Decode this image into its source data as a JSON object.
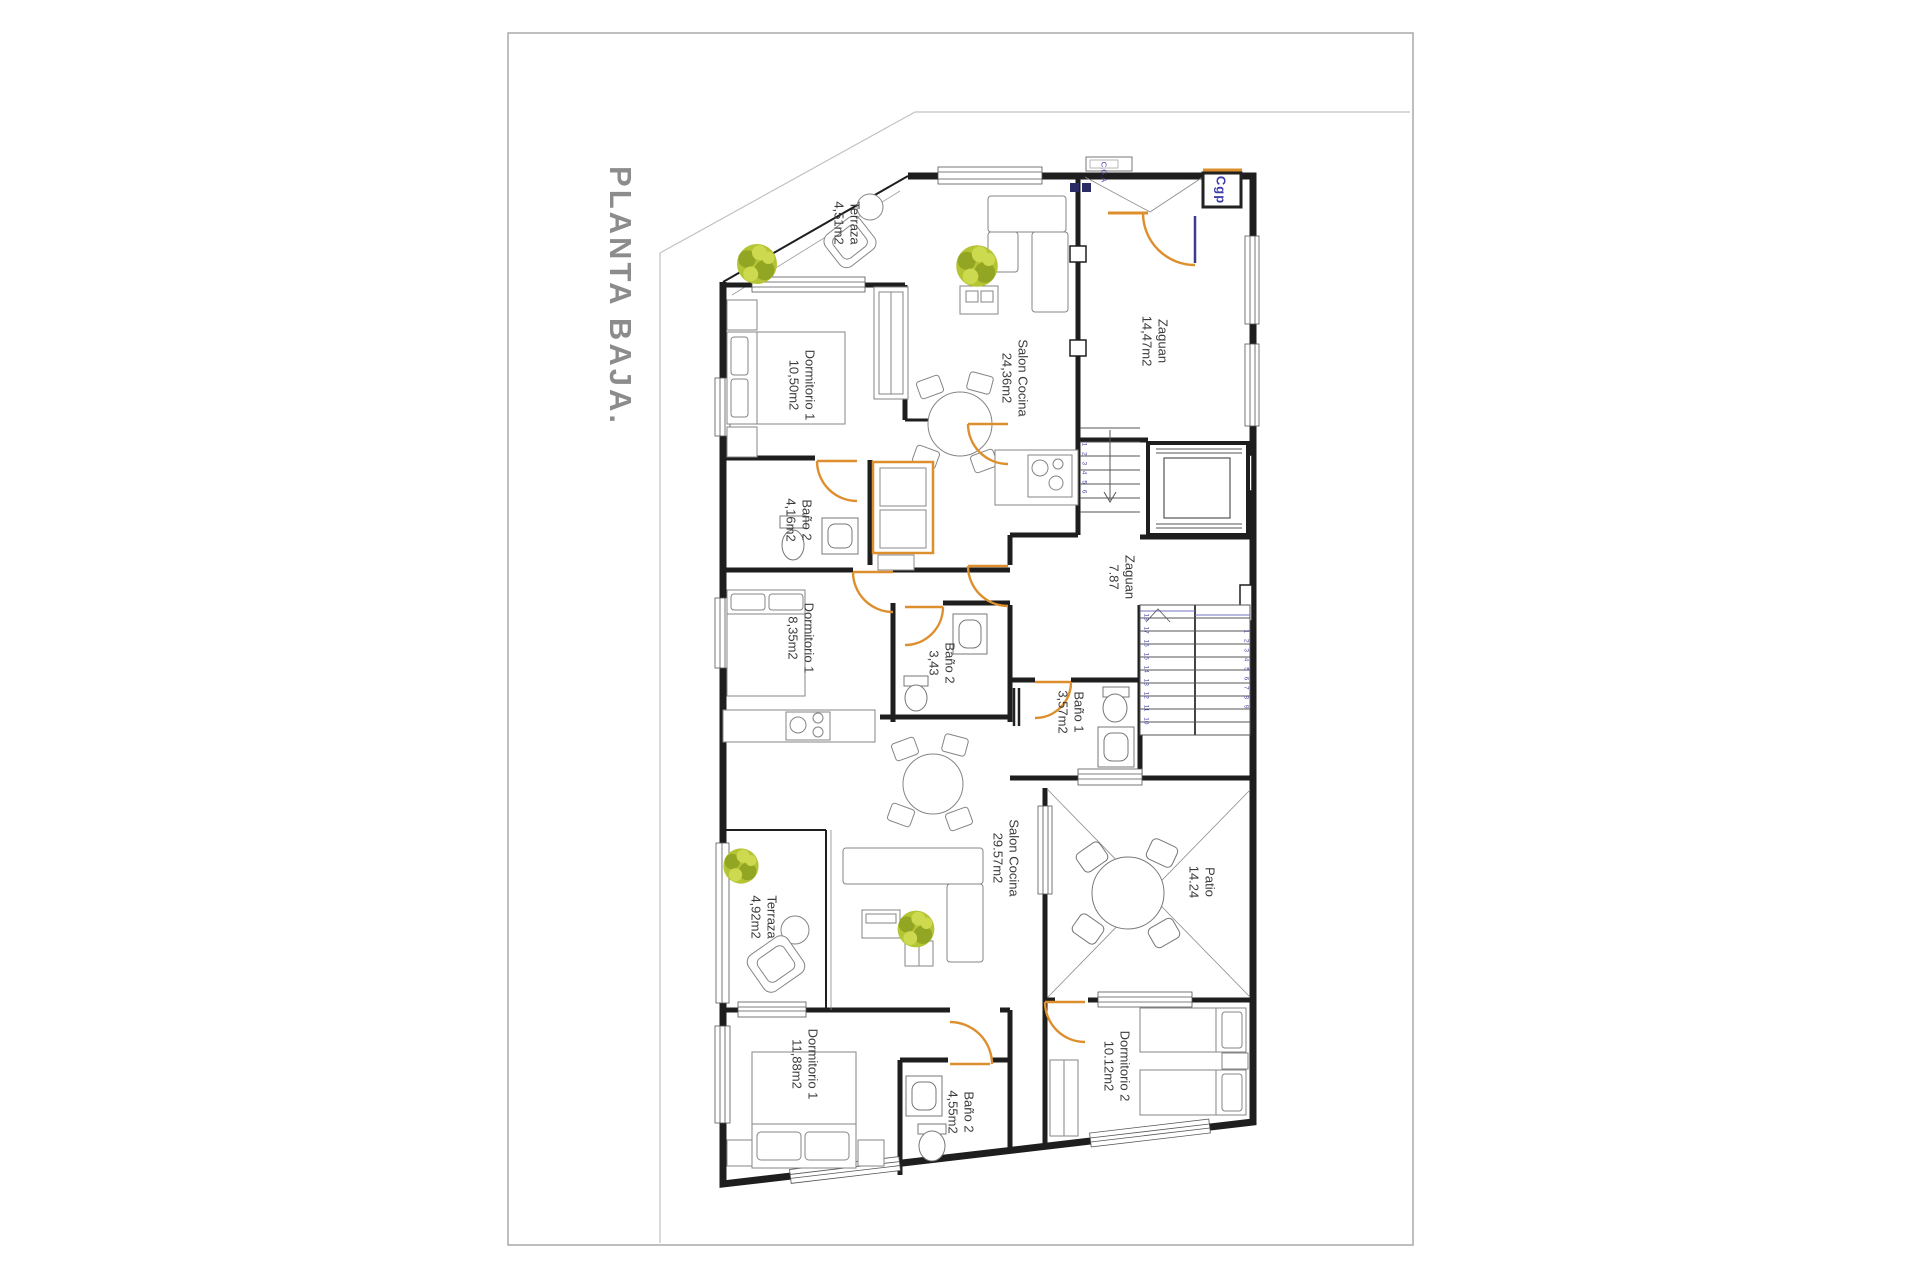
{
  "title": "PLANTA BAJA.",
  "rooms": [
    {
      "name": "Terraza",
      "area": "4,51m2"
    },
    {
      "name": "Dormitorio 1",
      "area": "10,50m2"
    },
    {
      "name": "Salon Cocina",
      "area": "24,36m2"
    },
    {
      "name": "Zaguan",
      "area": "14,47m2"
    },
    {
      "name": "Baño 2",
      "area": "4,16m2"
    },
    {
      "name": "Dormitorio 1",
      "area": "8,35m2"
    },
    {
      "name": "Baño 2",
      "area": "3,43"
    },
    {
      "name": "Zaguan",
      "area": "7.87"
    },
    {
      "name": "Baño 1",
      "area": "3,57m2"
    },
    {
      "name": "Salon Cocina",
      "area": "29.57m2"
    },
    {
      "name": "Patio",
      "area": "14.24"
    },
    {
      "name": "Terraza",
      "area": "4,92m2"
    },
    {
      "name": "Dormitorio 1",
      "area": "11,88m2"
    },
    {
      "name": "Baño 2",
      "area": "4,55m2"
    },
    {
      "name": "Dormitorio 2",
      "area": "10.12m2"
    }
  ],
  "annotations": {
    "cgp": "Cgp",
    "cga": "C.G.A"
  },
  "stairs": {
    "upper": "1 2 3 4 5 6",
    "lower_left": "18 17 16 15 14 13 12 11 10",
    "lower_right": "1 2 3 4 5 6 7 8 9"
  },
  "colors": {
    "door_accent": "#dd8f2e",
    "blue_accent": "#3c3ca8",
    "title_gray": "#8c8c8c",
    "wall": "#1e1e1e",
    "plant_green": "#b5c433"
  }
}
